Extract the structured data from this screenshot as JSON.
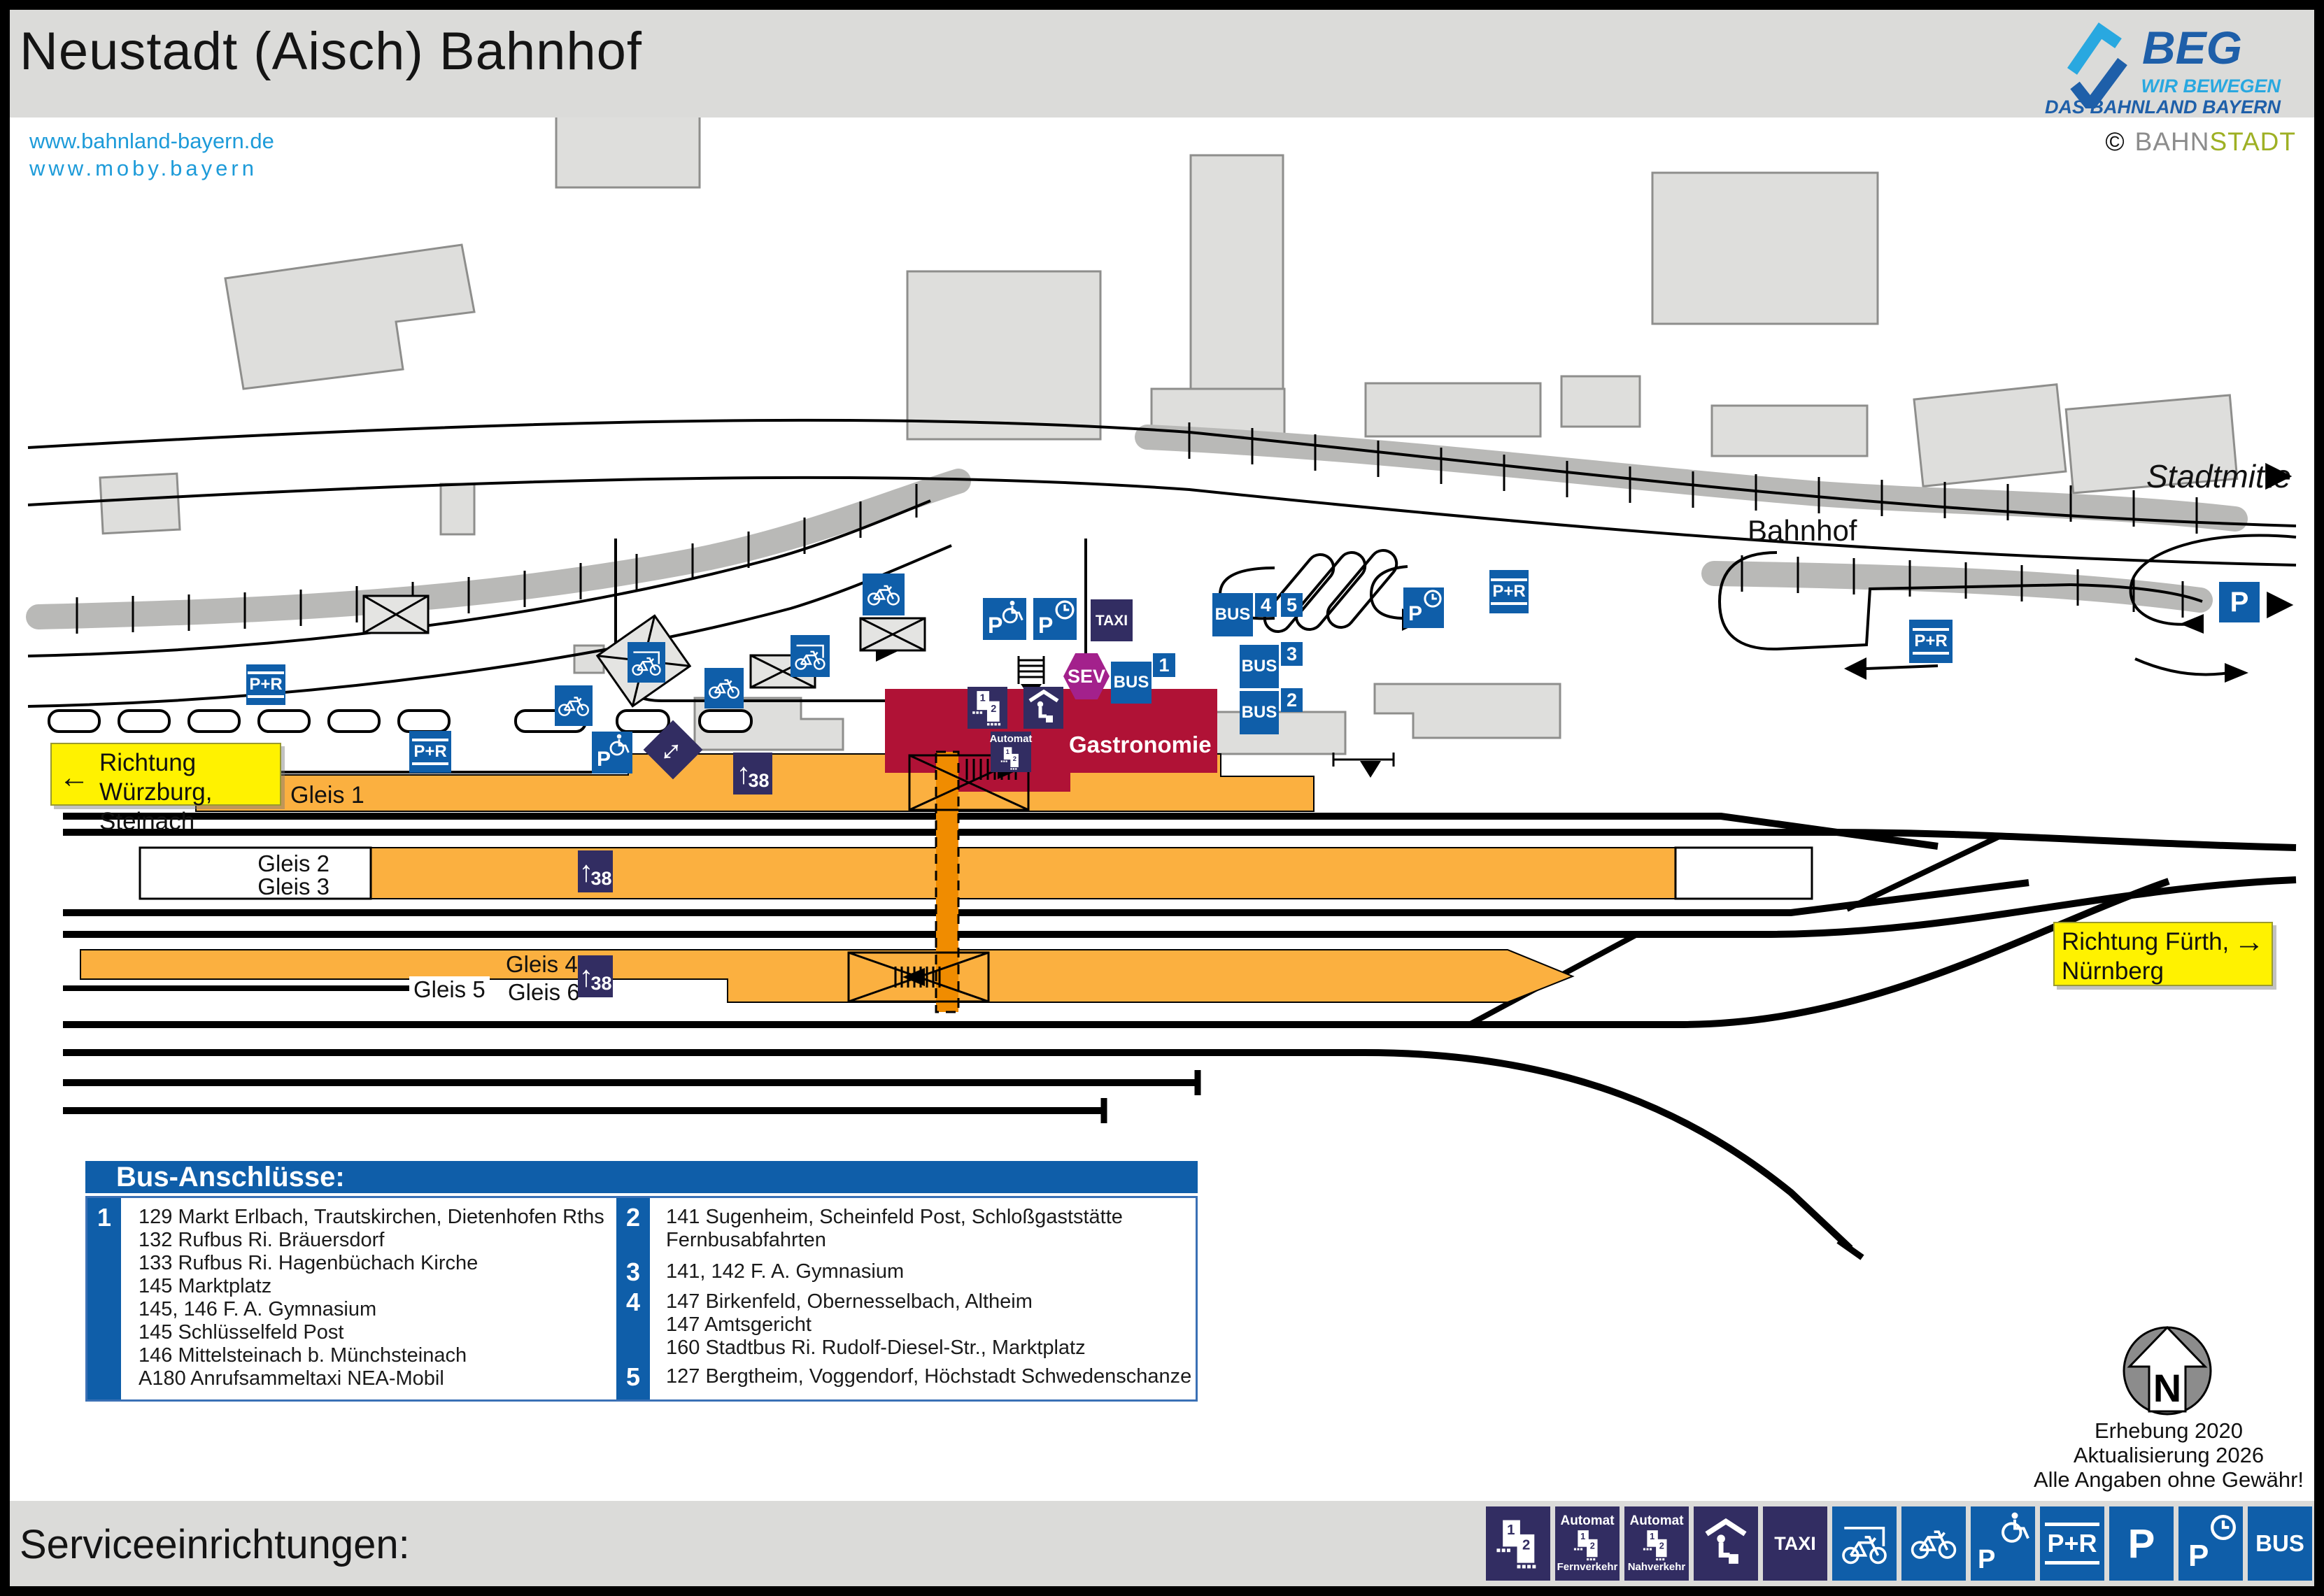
{
  "header": {
    "title": "Neustadt (Aisch) Bahnhof"
  },
  "links": {
    "line1": "www.bahnland-bayern.de",
    "line2": "www.moby.bayern"
  },
  "branding": {
    "beg_name": "BEG",
    "beg_tagline1": "WIR BEWEGEN",
    "beg_tagline2": "DAS BAHNLAND BAYERN",
    "credit_symbol": "©",
    "credit_part1": "BAHN",
    "credit_part2": "STADT"
  },
  "map": {
    "street": "Bahnhof",
    "stadtmitte": "Stadtmitte",
    "sign_west": {
      "arrow": "←",
      "line1": "Richtung Würzburg,",
      "line2": "Steinach"
    },
    "sign_east": {
      "arrow": "→",
      "line1": "Richtung Fürth,",
      "line2": "Nürnberg"
    },
    "gleis1": "Gleis 1",
    "gleis2": "Gleis 2",
    "gleis3": "Gleis 3",
    "gleis4": "Gleis 4",
    "gleis5": "Gleis 5",
    "gleis6": "Gleis 6",
    "station": {
      "gastronomie": "Gastronomie"
    },
    "labels": {
      "p": "P",
      "pr": "P+R",
      "taxi": "TAXI",
      "bus": "BUS",
      "sev": "SEV",
      "automat": "Automat",
      "fernverkehr": "Fernverkehr",
      "nahverkehr": "Nahverkehr",
      "height38": "38",
      "num1": "1",
      "num2": "2",
      "arrow_up": "↑",
      "arrow_right": "▶",
      "arrow_updown": "↕"
    },
    "bus_stop_badges": [
      "1",
      "2",
      "3",
      "4",
      "5"
    ]
  },
  "bus_legend": {
    "title": "Bus-Anschlüsse:",
    "entries": [
      {
        "num": "1",
        "lines": [
          "129 Markt Erlbach, Trautskirchen, Dietenhofen Rths",
          "132 Rufbus Ri. Bräuersdorf",
          "133 Rufbus Ri. Hagenbüchach Kirche",
          "145 Marktplatz",
          "145, 146 F. A. Gymnasium",
          "145 Schlüsselfeld Post",
          "146 Mittelsteinach b. Münchsteinach",
          "A180 Anrufsammeltaxi NEA-Mobil"
        ]
      },
      {
        "num": "2",
        "lines": [
          "141 Sugenheim, Scheinfeld Post, Schloßgaststätte",
          "Fernbusabfahrten"
        ]
      },
      {
        "num": "3",
        "lines": [
          "141, 142 F. A. Gymnasium"
        ]
      },
      {
        "num": "4",
        "lines": [
          "147 Birkenfeld, Obernesselbach, Altheim",
          "147 Amtsgericht",
          "160 Stadtbus Ri. Rudolf-Diesel-Str., Marktplatz"
        ]
      },
      {
        "num": "5",
        "lines": [
          "127 Bergtheim, Voggendorf, Höchstadt Schwedenschanze"
        ]
      }
    ]
  },
  "survey": {
    "north": "N",
    "line1": "Erhebung 2020",
    "line2": "Aktualisierung 2026",
    "line3": "Alle Angaben ohne Gewähr!"
  },
  "footer": {
    "title": "Serviceeinrichtungen:"
  },
  "colors": {
    "icon_blue": "#0F5EA9",
    "icon_navy": "#322D62",
    "sev_purple": "#A3218C",
    "platform_orange": "#FBB040",
    "underpass_orange": "#F08C00",
    "station_red": "#B01236",
    "sign_yellow": "#FFF200",
    "link_blue": "#1D9BD9",
    "header_gray": "#DBDBD9"
  }
}
